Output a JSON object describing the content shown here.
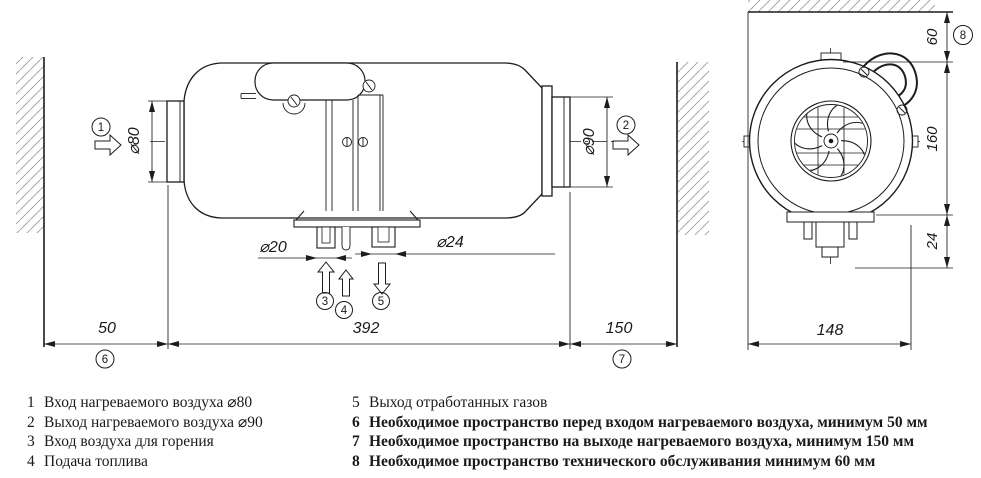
{
  "drawing": {
    "callouts": {
      "c1": "1",
      "c2": "2",
      "c3": "3",
      "c4": "4",
      "c5": "5",
      "c6": "6",
      "c7": "7",
      "c8": "8"
    },
    "dimensions": {
      "inlet_diameter": "⌀80",
      "outlet_diameter": "⌀90",
      "combustion_air_stub_diameter": "⌀20",
      "exhaust_stub_diameter": "⌀24",
      "heater_length": "392",
      "inlet_clearance": "50",
      "outlet_clearance": "150",
      "service_clearance": "60",
      "heater_height": "160",
      "stub_protrusion": "24",
      "heater_width": "148"
    },
    "line_color": "#1c1c1c",
    "hatch_color": "#9c9c9c"
  },
  "legend": {
    "left": [
      {
        "num": "1",
        "text": "Вход нагреваемого воздуха ⌀80"
      },
      {
        "num": "2",
        "text": "Выход нагреваемого воздуха ⌀90"
      },
      {
        "num": "3",
        "text": "Вход воздуха для горения"
      },
      {
        "num": "4",
        "text": "Подача топлива"
      }
    ],
    "right": [
      {
        "num": "5",
        "text": "Выход отработанных газов"
      },
      {
        "num": "6",
        "text": "Необходимое пространство перед входом нагреваемого воздуха, минимум 50 мм"
      },
      {
        "num": "7",
        "text": "Необходимое пространство на выходе нагреваемого воздуха, минимум 150 мм"
      },
      {
        "num": "8",
        "text": "Необходимое пространство технического обслуживания минимум 60 мм"
      }
    ]
  }
}
